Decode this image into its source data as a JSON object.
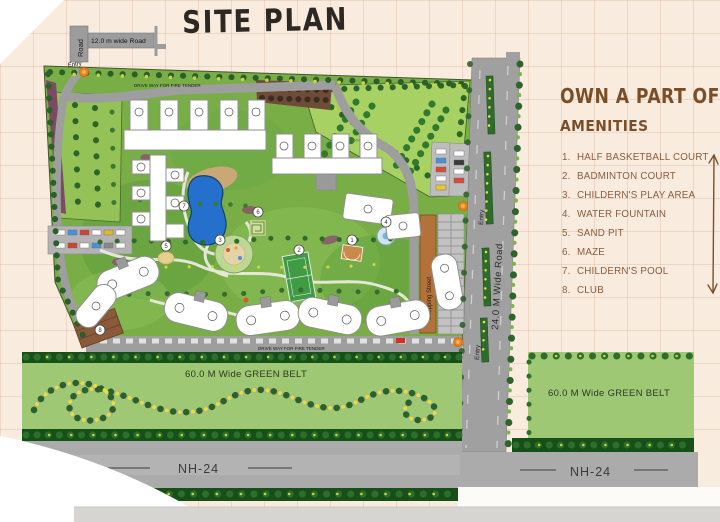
{
  "page": {
    "title": "SITE PLAN"
  },
  "right_panel": {
    "heading": "OWN A PART OF IT",
    "subheading": "AMENITIES",
    "amenities": [
      {
        "n": "1",
        "num": "1.",
        "label": "HALF BASKETBALL COURT"
      },
      {
        "n": "2",
        "num": "2.",
        "label": "BADMINTON COURT"
      },
      {
        "n": "3",
        "num": "3.",
        "label": "CHILDERN'S PLAY AREA"
      },
      {
        "n": "4",
        "num": "4.",
        "label": "WATER FOUNTAIN"
      },
      {
        "n": "5",
        "num": "5.",
        "label": "SAND PIT"
      },
      {
        "n": "6",
        "num": "6.",
        "label": "MAZE"
      },
      {
        "n": "7",
        "num": "7.",
        "label": "CHILDERN'S POOL"
      },
      {
        "n": "8",
        "num": "8.",
        "label": "CLUB"
      }
    ]
  },
  "map": {
    "road12": {
      "vertical_label": "Road",
      "label": "12.0 m wide Road"
    },
    "road24": {
      "label": "24.0 M Wide Road"
    },
    "labels": {
      "entry": "Entry",
      "driveway": "DRIVE WAY FOR FIRE TENDER",
      "shopping_street": "Shopping Street",
      "green_belt": "60.0 M Wide GREEN BELT",
      "nh24": "NH-24",
      "open_land": "OPEN LAND"
    }
  },
  "colors": {
    "accent_brown": "#7c4e28",
    "site_green": "#79ae47",
    "belt_green": "#9ec873",
    "road_grey": "#a5a5a5",
    "pool_blue": "#2470cc",
    "paper": "#f9ecdf"
  }
}
